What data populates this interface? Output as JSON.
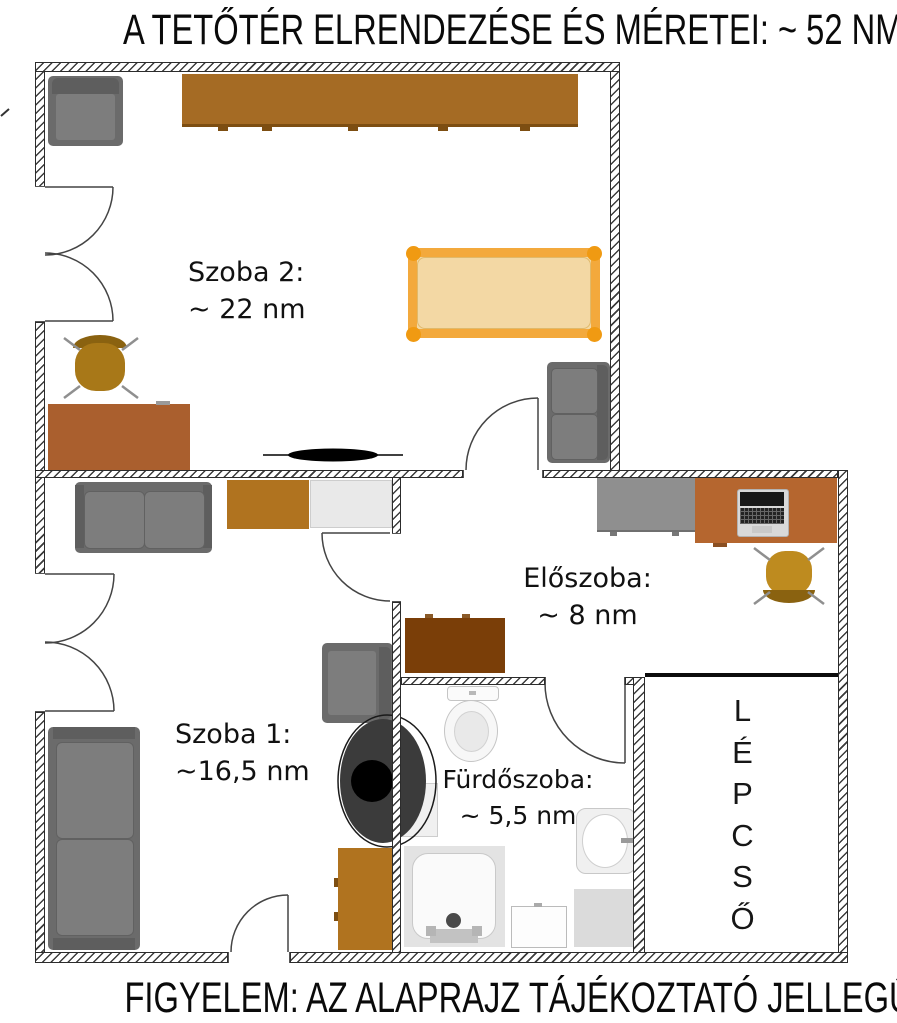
{
  "title": "A TETŐTÉR ELRENDEZÉSE ÉS MÉRETEI: ~ 52 NM",
  "footer": "FIGYELEM: AZ ALAPRAJZ TÁJÉKOZTATÓ JELLEGŰ",
  "rooms": {
    "szoba2": {
      "name": "Szoba 2:",
      "size": "~ 22 nm"
    },
    "szoba1": {
      "name": "Szoba 1:",
      "size": "~16,5 nm"
    },
    "eloszoba": {
      "name": "Előszoba:",
      "size": "~ 8 nm"
    },
    "furdoszoba": {
      "name": "Fürdőszoba:",
      "size": "~ 5,5 nm"
    },
    "lepcso": {
      "name": "LÉPCSŐ",
      "letters": [
        "L",
        "É",
        "P",
        "C",
        "S",
        "Ő"
      ]
    }
  },
  "colors": {
    "wood": "#A56B24",
    "desk_wood": "#AA5F2E",
    "ochre": "#B0731F",
    "dark_wood": "#7A3E08",
    "sienna": "#B5662F",
    "bed_frame": "#F3A93C",
    "bed_fill": "#F3D8A4",
    "bed_knob": "#F09A12",
    "sofa": "#6B6B6B",
    "sofa_dark": "#5E5E5E",
    "cushion": "#7D7D7D",
    "gold": "#A87818",
    "gold_light": "#BE8B1F",
    "cabinet_gray": "#8F8F8F",
    "light_unit": "#E9E9E9"
  }
}
